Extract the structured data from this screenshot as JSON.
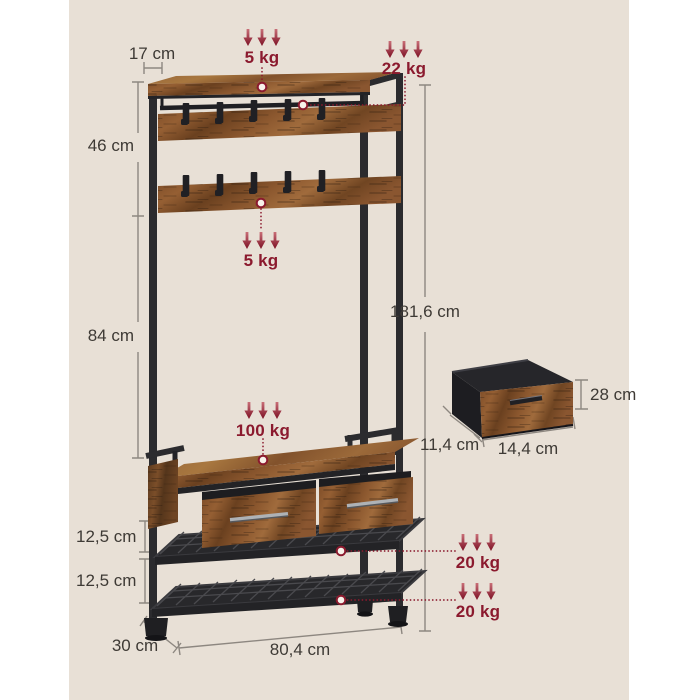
{
  "palette": {
    "page_bg": "#ffffff",
    "canvas_bg": "#e8e0d6",
    "accent_red": "#8b1a2e",
    "dim_text": "#3e3a35",
    "dim_line": "#8d8780",
    "metal": "#2b2b2e",
    "wood": "#8a5630"
  },
  "labels": {
    "dims": {
      "shelf_depth": "17 cm",
      "hook_section_height": "46 cm",
      "open_section_height": "84 cm",
      "total_height": "181,6 cm",
      "gap_upper": "12,5 cm",
      "gap_lower": "12,5 cm",
      "base_depth": "30 cm",
      "base_width": "80,4 cm"
    },
    "drawer": {
      "height": "28 cm",
      "depth": "11,4 cm",
      "width": "14,4 cm"
    },
    "loads": {
      "top_shelf": "5 kg",
      "hanging_rod": "22 kg",
      "hook_rail": "5 kg",
      "bench": "100 kg",
      "mesh_shelf_upper": "20 kg",
      "mesh_shelf_lower": "20 kg"
    }
  }
}
